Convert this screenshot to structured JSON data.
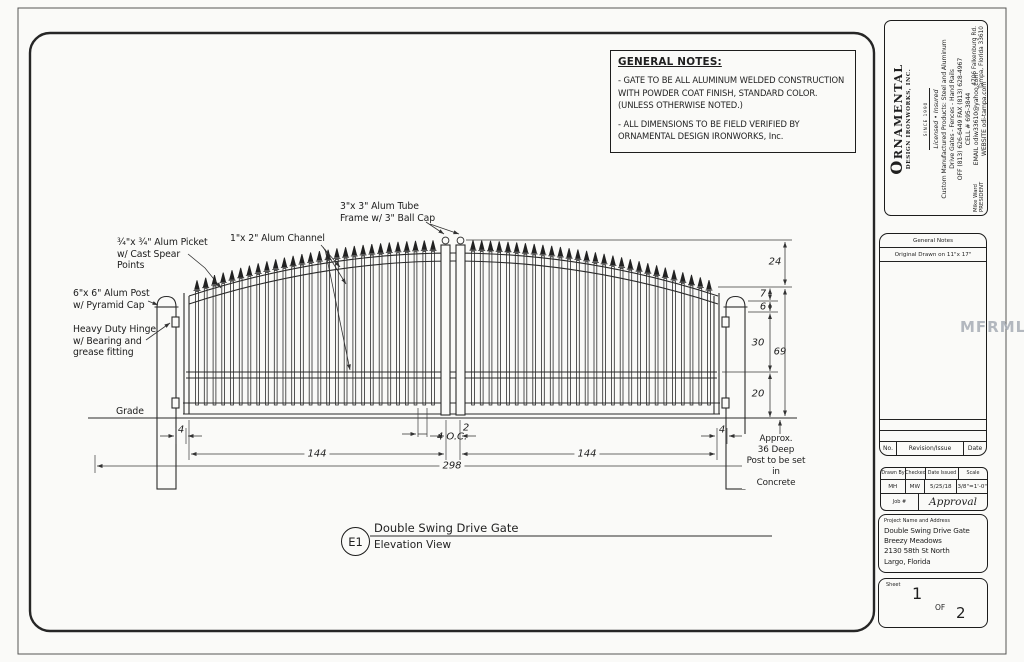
{
  "watermark": "MFRMLS",
  "general_notes": {
    "title": "GENERAL NOTES:",
    "note1": "- GATE TO BE ALL ALUMINUM WELDED CONSTRUCTION\nWITH POWDER COAT FINISH, STANDARD COLOR.\n(UNLESS OTHERWISE NOTED.)",
    "note2": "- ALL DIMENSIONS TO BE FIELD VERIFIED BY\nORNAMENTAL DESIGN IRONWORKS, Inc."
  },
  "company": {
    "name_initial": "O",
    "name_rest": "RNAMENTAL",
    "name_sub": "DESIGN IRONWORKS, INC.",
    "since": "SINCE 1990",
    "licensed": "Licensed • Insured",
    "products": "Custom Manufactured Products: Steel and Aluminum",
    "trades": "Drive Gates - Fences - Hand Rails",
    "phone": "OFF (813) 626-6449 FAX (813) 628-4967",
    "cell": "CELL # 695-3844",
    "email": "EMAIL odiw33610@yahoo.com",
    "website": "WEBSITE odi-tampa.com",
    "contact_name": "Mike Ward",
    "contact_title": "PRESIDENT",
    "address1": "4706 Falkenburg Rd.",
    "address2": "Tampa, Florida 33610"
  },
  "titleblock": {
    "general_notes_label": "General Notes",
    "original_drawn": "Original Drawn on 11\"x 17\"",
    "rev_no": "No.",
    "rev_label": "Revision/Issue",
    "rev_date": "Date",
    "drawn_by_label": "Drawn By",
    "drawn_by": "MH",
    "checked_label": "Checked",
    "checked": "MW",
    "date_label": "Date Issued",
    "date": "5/25/18",
    "scale_label": "Scale",
    "scale": "3/8\"=1'-0\"",
    "job_label": "Job #",
    "approval": "Approval",
    "project_label": "Project Name and Address",
    "project_lines": "Double Swing Drive Gate\nBreezy Meadows\n2130 58th St North\nLargo, Florida",
    "sheet_label": "Sheet",
    "sheet_no": "1",
    "sheet_of": "OF",
    "sheet_total": "2"
  },
  "drawing": {
    "labels": {
      "picket": "¾\"x ¾\" Alum Picket\nw/ Cast Spear\nPoints",
      "post": "6\"x 6\" Alum Post\nw/ Pyramid Cap",
      "hinge": "Heavy Duty Hinge\nw/ Bearing and\ngrease fitting",
      "channel": "1\"x 2\" Alum Channel",
      "tube": "3\"x 3\" Alum Tube\nFrame w/ 3\" Ball Cap",
      "grade": "Grade",
      "concrete": "Approx.\n36 Deep\nPost to be set in\nConcrete"
    },
    "dims": {
      "arch_rise": "24",
      "d7": "7",
      "d6": "6",
      "d30": "30",
      "d69": "69",
      "d20": "20",
      "left_gap": "4",
      "oc": "4 O.C.",
      "leaf_left": "144",
      "center_gap": "2",
      "leaf_right": "144",
      "right_gap": "4",
      "overall": "298"
    },
    "title": {
      "ref": "E1",
      "name": "Double Swing Drive Gate",
      "view": "Elevation View"
    }
  }
}
